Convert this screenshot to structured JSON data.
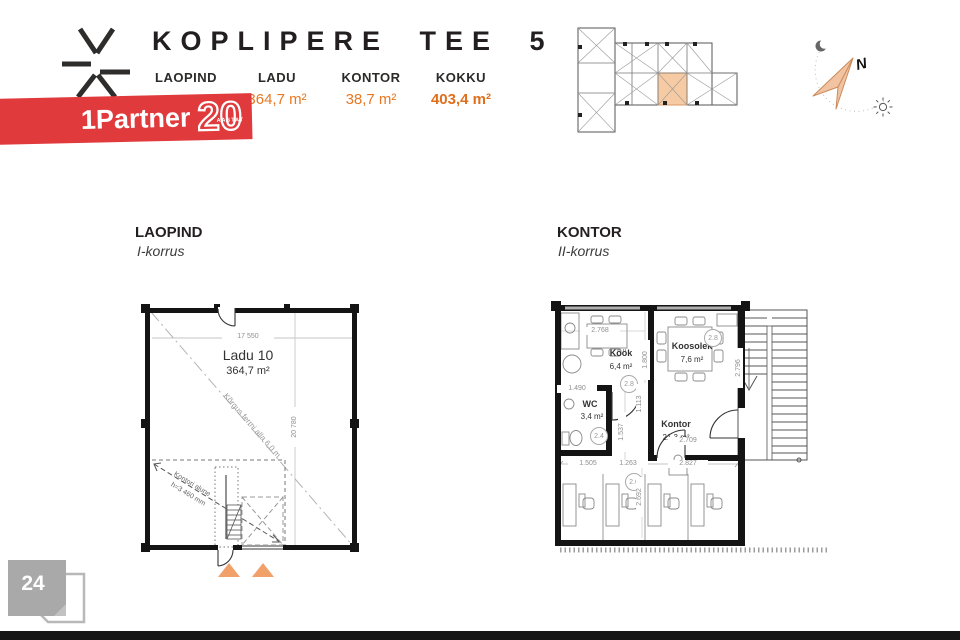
{
  "colors": {
    "accent_orange": "#E87722",
    "banner_red": "#E03A3C",
    "plan_highlight": "#F6CBA4",
    "triangle_orange": "#F1A06A"
  },
  "header": {
    "title": "KOPLIPERE TEE 5",
    "table": {
      "col1_label": "LAOPIND",
      "col2_label": "LADU",
      "col2_value": "364,7 m²",
      "col3_label": "KONTOR",
      "col3_value": "38,7 m²",
      "col4_label": "KOKKU",
      "col4_value": "403,4 m²"
    }
  },
  "banner": {
    "brand": "1Partner",
    "badge": "20",
    "badge_sub": "AASTAT"
  },
  "compass": {
    "north": "N"
  },
  "left_plan": {
    "title": "LAOPIND",
    "subtitle": "I-korrus",
    "room": "Ladu 10",
    "area": "364,7 m²",
    "dim_width": "17 550",
    "dim_height": "20 780",
    "truss_note": "Kõrgus fermi alla 6,0 m",
    "office_note_1": "Kontori alune",
    "office_note_2": "h=3 460 mm"
  },
  "right_plan": {
    "title": "KONTOR",
    "subtitle": "II-korrus",
    "kook_name": "Köök",
    "kook_area": "6,4 m²",
    "kook_tag": "2.8",
    "koosolek_name": "Koosolek",
    "koosolek_area": "7,6 m²",
    "koosolek_tag": "2.8",
    "wc_name": "WC",
    "wc_area": "3,4 m²",
    "wc_tag": "2.4",
    "kontor_name": "Kontor",
    "kontor_area": "21,3 m²",
    "kontor_tag": "2.6",
    "dims": {
      "top": "2.768",
      "kook_right": "1.800",
      "koosolek_right": "2.796",
      "koosolek_bottom": "2.709",
      "wc_top": "1.490",
      "mid_a": "1.113",
      "mid_b": "1.537",
      "bottom_a": "1.505",
      "bottom_b": "1.263",
      "bottom_c": "2.827",
      "office_v": "2.692"
    }
  },
  "page": {
    "number": "24"
  }
}
